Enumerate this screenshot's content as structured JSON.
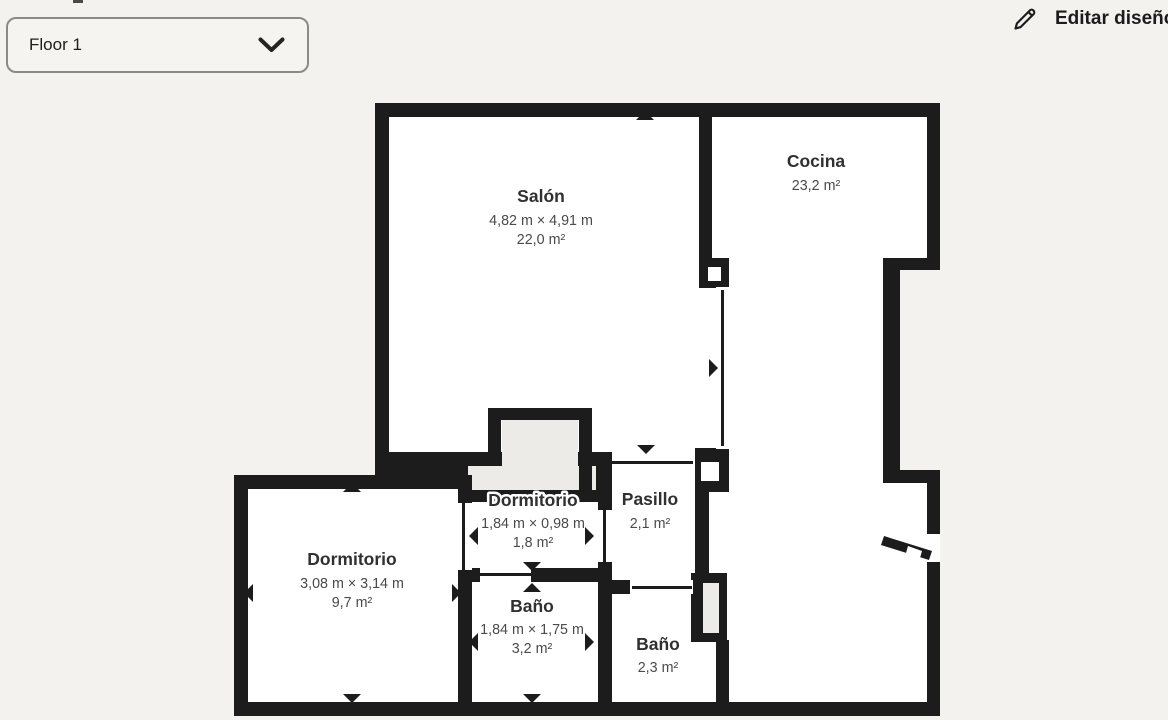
{
  "floor_selector": {
    "label": "Floor 1"
  },
  "edit_button": {
    "label": "Editar diseño"
  },
  "plan": {
    "colors": {
      "wall": "#1c1c1c",
      "room": "#ffffff",
      "bg": "#f3f2ef",
      "unassigned": "#edebe8",
      "title_text": "#303030",
      "dim_text": "#4a4a4a"
    },
    "footprint": "375,103 940,103 940,270 900,270 900,470 940,470 940,716 234,716 234,475 375,475",
    "white_areas": [
      [
        389,
        117,
        310,
        335
      ],
      [
        389,
        288,
        327,
        161
      ],
      [
        712,
        117,
        215,
        141
      ],
      [
        729,
        258,
        154,
        232
      ],
      [
        709,
        483,
        218,
        219
      ],
      [
        248,
        489,
        210,
        213
      ],
      [
        472,
        502,
        126,
        66
      ],
      [
        472,
        582,
        126,
        120
      ],
      [
        612,
        466,
        83,
        114
      ],
      [
        612,
        594,
        104,
        108
      ]
    ],
    "gray_areas": [
      [
        502,
        420,
        76,
        46
      ],
      [
        468,
        466,
        128,
        24
      ]
    ],
    "walls": [
      [
        699,
        116,
        13,
        146
      ],
      [
        699,
        258,
        30,
        29
      ],
      [
        695,
        448,
        34,
        44
      ],
      [
        598,
        452,
        14,
        142
      ],
      [
        695,
        452,
        14,
        128
      ],
      [
        375,
        452,
        118,
        14
      ],
      [
        488,
        408,
        13,
        58
      ],
      [
        488,
        408,
        104,
        12
      ],
      [
        579,
        408,
        13,
        82
      ],
      [
        579,
        452,
        33,
        14
      ],
      [
        458,
        490,
        154,
        12
      ],
      [
        458,
        475,
        14,
        227
      ],
      [
        234,
        475,
        238,
        14
      ],
      [
        234,
        475,
        14,
        241
      ],
      [
        458,
        568,
        154,
        14
      ],
      [
        598,
        580,
        14,
        122
      ],
      [
        716,
        640,
        13,
        62
      ],
      [
        691,
        573,
        36,
        69
      ]
    ],
    "openings": [
      [
        716,
        287,
        15,
        162
      ],
      [
        612,
        452,
        83,
        14
      ],
      [
        630,
        580,
        63,
        14
      ],
      [
        480,
        568,
        51,
        14
      ],
      [
        458,
        503,
        14,
        67
      ],
      [
        598,
        510,
        14,
        52
      ],
      [
        927,
        534,
        13,
        28
      ]
    ],
    "thin_lines": [
      [
        721,
        290,
        3,
        156
      ],
      [
        612,
        461,
        81,
        3
      ],
      [
        632,
        586,
        60,
        3
      ],
      [
        480,
        573,
        51,
        3
      ],
      [
        462,
        503,
        3,
        67
      ],
      [
        603,
        510,
        3,
        52
      ]
    ],
    "white_insets": [
      [
        708,
        267,
        13,
        14
      ],
      [
        701,
        462,
        18,
        19
      ]
    ],
    "gray_insets": [
      [
        703,
        583,
        16,
        50
      ]
    ],
    "door_leaf": "884,536 932,551 929,560 881,545",
    "door_leaf_gap": "908,546 922,551 920,558 906,553",
    "arrows": [
      [
        645,
        116,
        "up"
      ],
      [
        385,
        368,
        "left"
      ],
      [
        713,
        368,
        "right"
      ],
      [
        646,
        449,
        "down"
      ],
      [
        352,
        488,
        "up"
      ],
      [
        249,
        593,
        "left"
      ],
      [
        456,
        593,
        "right"
      ],
      [
        352,
        698,
        "down"
      ],
      [
        474,
        536,
        "left"
      ],
      [
        589,
        536,
        "right"
      ],
      [
        532,
        566,
        "down"
      ],
      [
        532,
        588,
        "up"
      ],
      [
        474,
        642,
        "left"
      ],
      [
        589,
        642,
        "right"
      ],
      [
        532,
        698,
        "down"
      ]
    ],
    "rooms": [
      {
        "name": "Salón",
        "dims": "4,82 m × 4,91 m",
        "area": "22,0 m²",
        "cx": 541,
        "title_y": 202,
        "dims_y": 225,
        "area_y": 244,
        "halo": false
      },
      {
        "name": "Cocina",
        "dims": null,
        "area": "23,2 m²",
        "cx": 816,
        "title_y": 167,
        "dims_y": null,
        "area_y": 190,
        "halo": false
      },
      {
        "name": "Dormitorio",
        "dims": "3,08 m × 3,14 m",
        "area": "9,7 m²",
        "cx": 352,
        "title_y": 565,
        "dims_y": 588,
        "area_y": 607,
        "halo": false
      },
      {
        "name": "Dormitorio",
        "dims": "1,84 m × 0,98 m",
        "area": "1,8 m²",
        "cx": 533,
        "title_y": 506,
        "dims_y": 528,
        "area_y": 547,
        "halo": true
      },
      {
        "name": "Pasillo",
        "dims": null,
        "area": "2,1 m²",
        "cx": 650,
        "title_y": 505,
        "dims_y": null,
        "area_y": 528,
        "halo": false
      },
      {
        "name": "Baño",
        "dims": "1,84 m × 1,75 m",
        "area": "3,2 m²",
        "cx": 532,
        "title_y": 612,
        "dims_y": 634,
        "area_y": 653,
        "halo": false
      },
      {
        "name": "Baño",
        "dims": null,
        "area": "2,3 m²",
        "cx": 658,
        "title_y": 650,
        "dims_y": null,
        "area_y": 672,
        "halo": false
      }
    ]
  }
}
